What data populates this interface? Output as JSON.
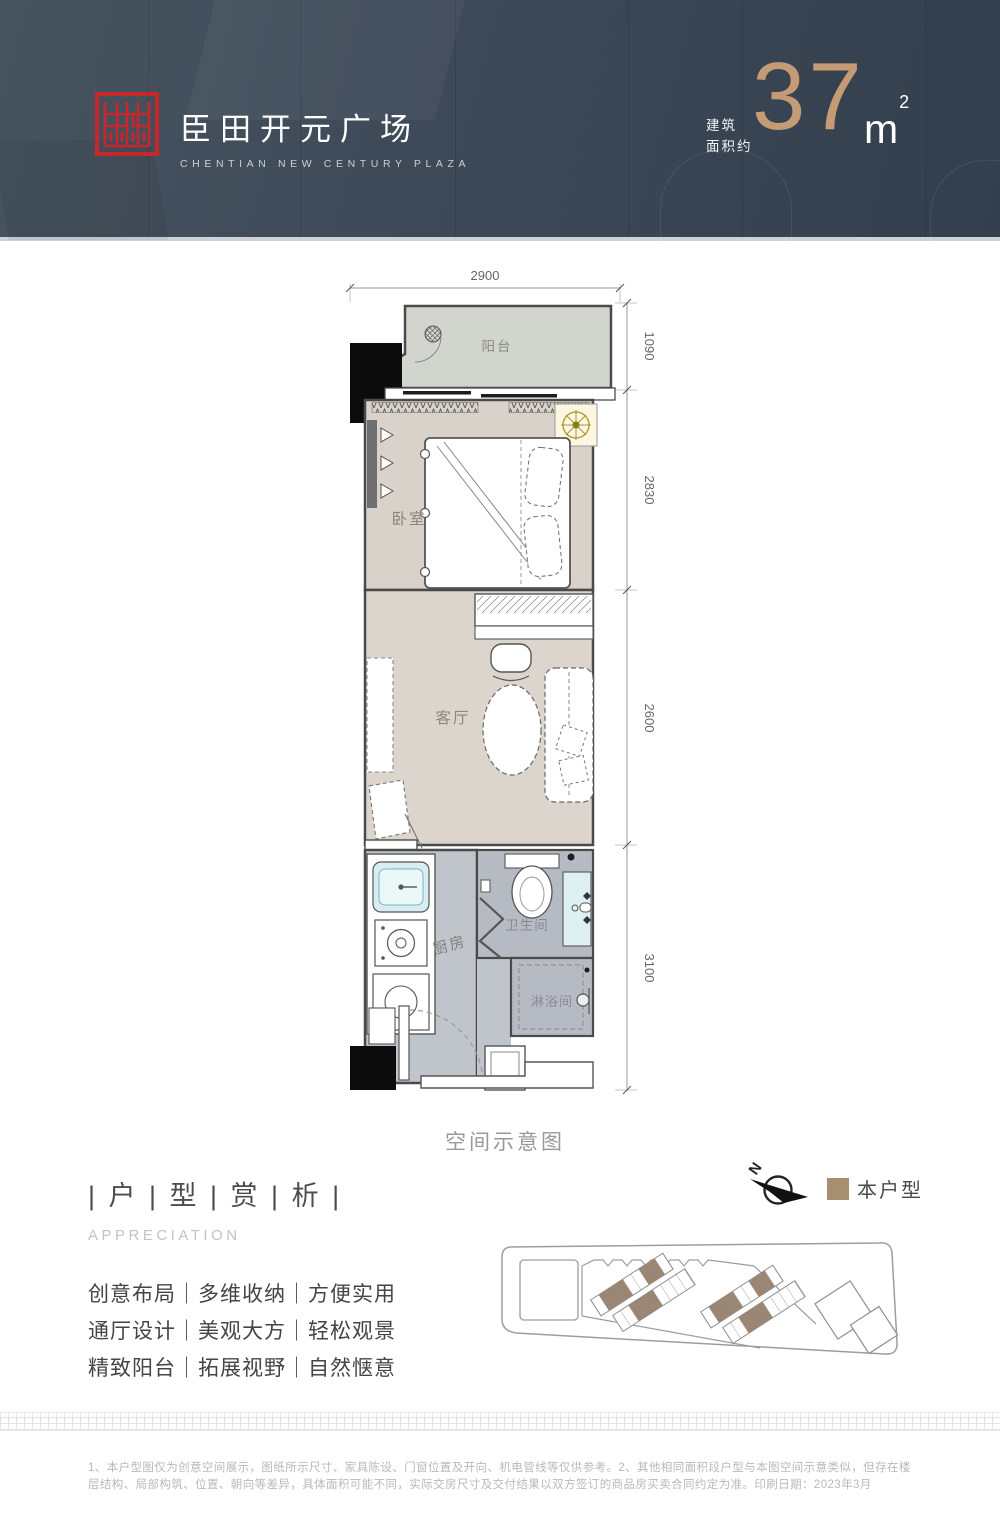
{
  "header": {
    "title": "臣田开元广场",
    "subtitle": "CHENTIAN NEW CENTURY PLAZA",
    "area_label_line1": "建筑",
    "area_label_line2": "面积约",
    "area_value": "37",
    "area_unit": "m",
    "area_exponent": "2",
    "accent_gold": "#c49b74",
    "brand_red": "#c5272d",
    "bg_color": "#3e4a58"
  },
  "floorplan": {
    "caption": "空间示意图",
    "dimensions": {
      "width_top": "2900",
      "balcony_depth": "1090",
      "bedroom_depth": "2830",
      "living_depth": "2600",
      "kitchen_depth": "3100"
    },
    "rooms": {
      "balcony": "阳台",
      "bedroom": "卧室",
      "living": "客厅",
      "kitchen": "厨房",
      "bathroom": "卫生间",
      "shower": "淋浴间"
    }
  },
  "appreciation": {
    "title": "| 户 | 型 | 赏 | 析 |",
    "subtitle": "APPRECIATION",
    "features": [
      "创意布局｜多维收纳｜方便实用",
      "通厅设计｜美观大方｜轻松观景",
      "精致阳台｜拓展视野｜自然惬意"
    ]
  },
  "legend": {
    "compass_letter": "N",
    "label": "本户型",
    "swatch_color": "#a68e71"
  },
  "footer": {
    "disclaimer": "1、本户型图仅为创意空间展示，图纸所示尺寸、家具陈设、门窗位置及开向、机电管线等仅供参考。2、其他相同面积段户型与本图空间示意类似，但存在楼层结构、局部构筑、位置、朝向等差异，具体面积可能不同，实际交房尺寸及交付结果以双方签订的商品房买卖合同约定为准。印刷日期：2023年3月"
  }
}
